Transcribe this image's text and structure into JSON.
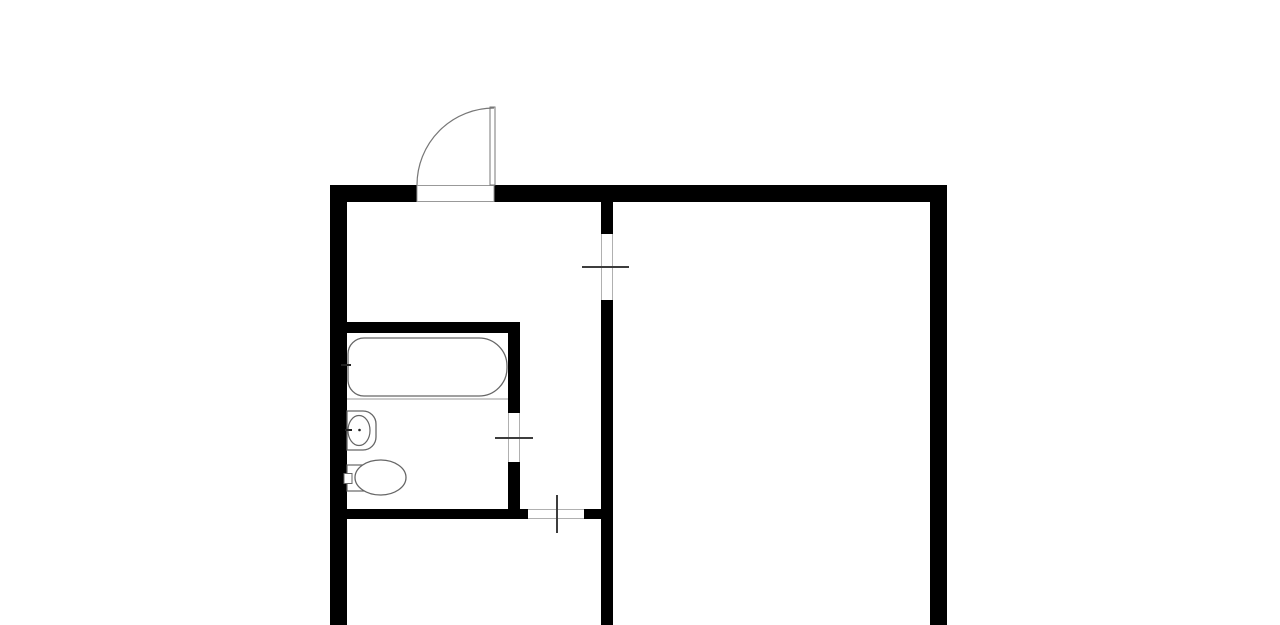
{
  "document": {
    "kind": "apartment-floor-plan",
    "description": "Black-and-white architectural floor plan: entrance hall with entry door at top, bathroom with bathtub, sink and toilet at left, hallway with interior door openings, and a large room on the right. Walls are cut off at the bottom edge of the image."
  },
  "canvas": {
    "width": 1280,
    "height": 625,
    "background": "#ffffff"
  },
  "palette": {
    "wall": "#000000",
    "white": "#ffffff",
    "fixture": "#666666",
    "door": "#777777",
    "threshold": "#999999",
    "frame": "#b0b0b0",
    "deck": "#999999",
    "marker": "#3d3d3d",
    "accent": "#222222",
    "none": "none"
  },
  "shapes": [
    {
      "type": "rect",
      "name": "exterior-top-wall-left",
      "x": 330,
      "y": 185,
      "w": 87,
      "h": 17,
      "fill": "wall"
    },
    {
      "type": "rect",
      "name": "exterior-top-wall-right",
      "x": 494,
      "y": 185,
      "w": 453,
      "h": 17,
      "fill": "wall"
    },
    {
      "type": "rect",
      "name": "exterior-left-wall",
      "x": 330,
      "y": 185,
      "w": 17,
      "h": 440,
      "fill": "wall"
    },
    {
      "type": "rect",
      "name": "exterior-right-wall",
      "x": 930,
      "y": 185,
      "w": 17,
      "h": 440,
      "fill": "wall"
    },
    {
      "type": "rect",
      "name": "partition-wall-upper-segment",
      "x": 601,
      "y": 202,
      "w": 12,
      "h": 32,
      "fill": "wall"
    },
    {
      "type": "rect",
      "name": "partition-wall-lower-segment",
      "x": 601,
      "y": 300,
      "w": 12,
      "h": 325,
      "fill": "wall"
    },
    {
      "type": "rect",
      "name": "bathroom-top-wall",
      "x": 347,
      "y": 322,
      "w": 173,
      "h": 11,
      "fill": "wall"
    },
    {
      "type": "rect",
      "name": "bathroom-right-wall-upper",
      "x": 508,
      "y": 333,
      "w": 12,
      "h": 80,
      "fill": "wall"
    },
    {
      "type": "rect",
      "name": "bathroom-right-wall-lower",
      "x": 508,
      "y": 462,
      "w": 12,
      "h": 47,
      "fill": "wall"
    },
    {
      "type": "rect",
      "name": "hall-bottom-wall-left",
      "x": 347,
      "y": 509,
      "w": 181,
      "h": 10,
      "fill": "wall"
    },
    {
      "type": "rect",
      "name": "hall-bottom-wall-right",
      "x": 584,
      "y": 509,
      "w": 17,
      "h": 10,
      "fill": "wall"
    },
    {
      "type": "rect",
      "name": "entry-door-threshold",
      "x": 417,
      "y": 185.5,
      "w": 77,
      "h": 16,
      "fill": "white",
      "stroke": "threshold",
      "sw": 1
    },
    {
      "type": "rect",
      "name": "entry-door-leaf",
      "x": 490,
      "y": 107,
      "w": 5,
      "h": 78,
      "fill": "white",
      "stroke": "door",
      "sw": 1
    },
    {
      "type": "path",
      "name": "entry-door-swing-arc",
      "d": "M417 185 A77 77 0 0 1 494 108",
      "fill": "none",
      "stroke": "door",
      "sw": 1.2
    },
    {
      "type": "line",
      "name": "partition-opening-jamb-left",
      "x1": 601.5,
      "y1": 234,
      "x2": 601.5,
      "y2": 300,
      "stroke": "frame",
      "sw": 1
    },
    {
      "type": "line",
      "name": "partition-opening-jamb-right",
      "x1": 612.5,
      "y1": 234,
      "x2": 612.5,
      "y2": 300,
      "stroke": "frame",
      "sw": 1
    },
    {
      "type": "line",
      "name": "partition-opening-marker",
      "x1": 582,
      "y1": 267,
      "x2": 629,
      "y2": 267,
      "stroke": "marker",
      "sw": 2
    },
    {
      "type": "line",
      "name": "bathroom-door-jamb-left",
      "x1": 508.5,
      "y1": 413,
      "x2": 508.5,
      "y2": 462,
      "stroke": "frame",
      "sw": 1
    },
    {
      "type": "line",
      "name": "bathroom-door-jamb-right",
      "x1": 519.5,
      "y1": 413,
      "x2": 519.5,
      "y2": 462,
      "stroke": "frame",
      "sw": 1
    },
    {
      "type": "line",
      "name": "bathroom-door-marker",
      "x1": 495,
      "y1": 438,
      "x2": 533,
      "y2": 438,
      "stroke": "marker",
      "sw": 2
    },
    {
      "type": "line",
      "name": "hall-door-jamb-top",
      "x1": 528,
      "y1": 509.5,
      "x2": 584,
      "y2": 509.5,
      "stroke": "frame",
      "sw": 1
    },
    {
      "type": "line",
      "name": "hall-door-jamb-bottom",
      "x1": 528,
      "y1": 518.5,
      "x2": 584,
      "y2": 518.5,
      "stroke": "frame",
      "sw": 1
    },
    {
      "type": "line",
      "name": "hall-door-marker",
      "x1": 557,
      "y1": 495,
      "x2": 557,
      "y2": 533,
      "stroke": "marker",
      "sw": 2
    },
    {
      "type": "line",
      "name": "bathtub-deck-line",
      "x1": 347,
      "y1": 399,
      "x2": 508,
      "y2": 399,
      "stroke": "deck",
      "sw": 1
    },
    {
      "type": "path",
      "name": "bathtub",
      "d": "M364 338 H479 A28 28 0 0 1 507 366 V368 A28 28 0 0 1 479 396 H364 A16 16 0 0 1 348 380 V354 A16 16 0 0 1 364 338 Z",
      "fill": "white",
      "stroke": "fixture",
      "sw": 1.3
    },
    {
      "type": "line",
      "name": "bathtub-faucet-mark",
      "x1": 341,
      "y1": 365,
      "x2": 351,
      "y2": 365,
      "stroke": "accent",
      "sw": 2
    },
    {
      "type": "path",
      "name": "sink",
      "d": "M347 411 H363 A13 13 0 0 1 376 424 V437 A13 13 0 0 1 363 450 H347 Z",
      "fill": "white",
      "stroke": "fixture",
      "sw": 1.3
    },
    {
      "type": "ellipse",
      "name": "sink-basin",
      "cx": 359,
      "cy": 430.5,
      "rx": 11,
      "ry": 15,
      "fill": "none",
      "stroke": "fixture",
      "sw": 1.2
    },
    {
      "type": "line",
      "name": "sink-faucet-mark",
      "x1": 345,
      "y1": 430,
      "x2": 352,
      "y2": 430,
      "stroke": "accent",
      "sw": 2
    },
    {
      "type": "circle",
      "name": "sink-drain-dot",
      "cx": 359.5,
      "cy": 430,
      "r": 1.3,
      "fill": "accent"
    },
    {
      "type": "rect",
      "name": "toilet-tank",
      "x": 347,
      "y": 465,
      "w": 21,
      "h": 26,
      "fill": "white",
      "stroke": "fixture",
      "sw": 1.2
    },
    {
      "type": "rect",
      "name": "toilet-flush-button",
      "x": 344,
      "y": 473.5,
      "w": 8,
      "h": 10,
      "fill": "white",
      "stroke": "fixture",
      "sw": 1
    },
    {
      "type": "ellipse",
      "name": "toilet-bowl",
      "cx": 380.5,
      "cy": 477.5,
      "rx": 25.5,
      "ry": 17.5,
      "fill": "white",
      "stroke": "fixture",
      "sw": 1.3
    }
  ]
}
